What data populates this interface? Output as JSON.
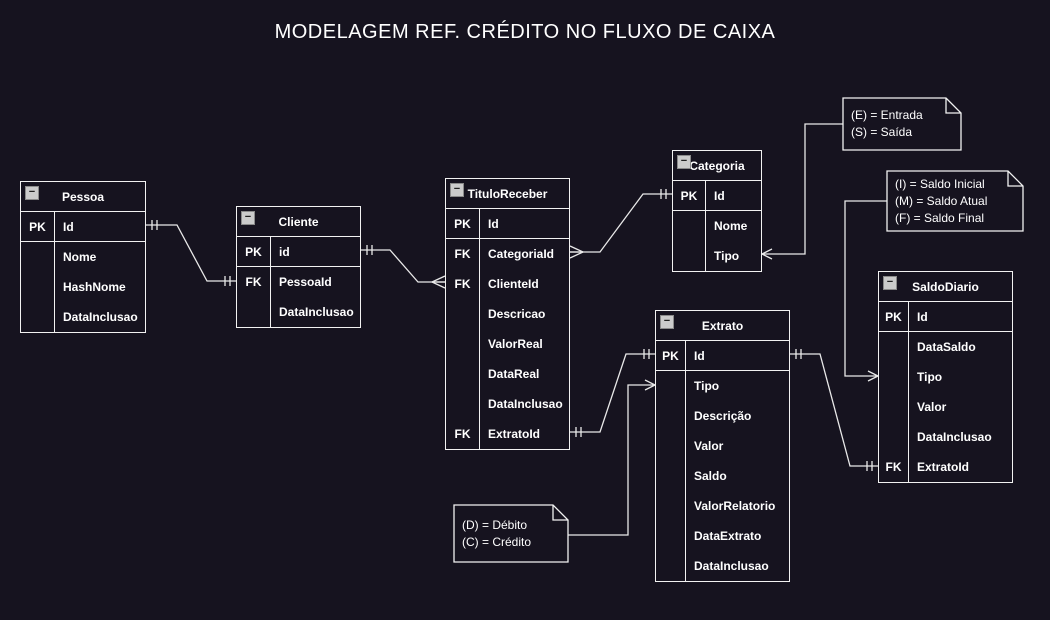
{
  "title": "MODELAGEM REF. CRÉDITO NO FLUXO DE CAIXA",
  "colors": {
    "background": "#16131f",
    "stroke": "#e9e9e9",
    "entity_border": "#f2f2f2",
    "text": "#ffffff",
    "collapse_icon_bg": "#cbcbcb"
  },
  "collapse_glyph": "−",
  "entities": [
    {
      "id": "pessoa",
      "title": "Pessoa",
      "x": 20,
      "y": 181,
      "width": 126,
      "keyColWidth": 34,
      "rows": [
        {
          "key": "PK",
          "name": "Id",
          "primary": true
        },
        {
          "key": "",
          "name": "Nome"
        },
        {
          "key": "",
          "name": "HashNome"
        },
        {
          "key": "",
          "name": "DataInclusao"
        }
      ]
    },
    {
      "id": "cliente",
      "title": "Cliente",
      "x": 236,
      "y": 206,
      "width": 125,
      "keyColWidth": 34,
      "rows": [
        {
          "key": "PK",
          "name": "id",
          "primary": true
        },
        {
          "key": "FK",
          "name": "PessoaId"
        },
        {
          "key": "",
          "name": "DataInclusao"
        }
      ]
    },
    {
      "id": "tituloreceber",
      "title": "TituloReceber",
      "x": 445,
      "y": 178,
      "width": 125,
      "keyColWidth": 34,
      "rows": [
        {
          "key": "PK",
          "name": "Id",
          "primary": true
        },
        {
          "key": "FK",
          "name": "CategoriaId"
        },
        {
          "key": "FK",
          "name": "ClienteId"
        },
        {
          "key": "",
          "name": "Descricao"
        },
        {
          "key": "",
          "name": "ValorReal"
        },
        {
          "key": "",
          "name": "DataReal"
        },
        {
          "key": "",
          "name": "DataInclusao"
        },
        {
          "key": "FK",
          "name": "ExtratoId"
        }
      ]
    },
    {
      "id": "categoria",
      "title": "Categoria",
      "x": 672,
      "y": 150,
      "width": 90,
      "keyColWidth": 33,
      "rows": [
        {
          "key": "PK",
          "name": "Id",
          "primary": true
        },
        {
          "key": "",
          "name": "Nome"
        },
        {
          "key": "",
          "name": "Tipo"
        }
      ]
    },
    {
      "id": "extrato",
      "title": "Extrato",
      "x": 655,
      "y": 310,
      "width": 135,
      "keyColWidth": 30,
      "rows": [
        {
          "key": "PK",
          "name": "Id",
          "primary": true
        },
        {
          "key": "",
          "name": "Tipo"
        },
        {
          "key": "",
          "name": "Descrição"
        },
        {
          "key": "",
          "name": "Valor"
        },
        {
          "key": "",
          "name": "Saldo"
        },
        {
          "key": "",
          "name": "ValorRelatorio"
        },
        {
          "key": "",
          "name": "DataExtrato"
        },
        {
          "key": "",
          "name": "DataInclusao"
        }
      ]
    },
    {
      "id": "saldodiario",
      "title": "SaldoDiario",
      "x": 878,
      "y": 271,
      "width": 135,
      "keyColWidth": 30,
      "rows": [
        {
          "key": "PK",
          "name": "Id",
          "primary": true
        },
        {
          "key": "",
          "name": "DataSaldo"
        },
        {
          "key": "",
          "name": "Tipo"
        },
        {
          "key": "",
          "name": "Valor"
        },
        {
          "key": "",
          "name": "DataInclusao"
        },
        {
          "key": "FK",
          "name": "ExtratoId"
        }
      ]
    }
  ],
  "notes": [
    {
      "id": "entrada-saida",
      "x": 843,
      "y": 98,
      "width": 118,
      "height": 52,
      "lines": [
        "(E) = Entrada",
        "(S) = Saída"
      ]
    },
    {
      "id": "saldo-legend",
      "x": 887,
      "y": 171,
      "width": 136,
      "height": 60,
      "lines": [
        "(I) = Saldo Inicial",
        "(M) = Saldo Atual",
        "(F) = Saldo Final"
      ]
    },
    {
      "id": "debito-credito",
      "x": 454,
      "y": 505,
      "width": 114,
      "height": 57,
      "lines": [
        "(D) = Débito",
        "(C) = Crédito"
      ]
    }
  ],
  "edges": [
    {
      "id": "pessoa-cliente",
      "from": "Pessoa.Id",
      "to": "Cliente.PessoaId",
      "points": [
        [
          146,
          225
        ],
        [
          177,
          225
        ],
        [
          207,
          281
        ],
        [
          236,
          281
        ]
      ],
      "startMarker": "one",
      "endMarker": "one"
    },
    {
      "id": "cliente-tituloreceber",
      "from": "Cliente.id",
      "to": "TituloReceber.ClienteId",
      "points": [
        [
          361,
          250
        ],
        [
          390,
          250
        ],
        [
          418,
          282
        ],
        [
          445,
          282
        ]
      ],
      "startMarker": "one",
      "endMarker": "many"
    },
    {
      "id": "tituloreceber-categoria",
      "from": "TituloReceber.CategoriaId",
      "to": "Categoria.Id",
      "points": [
        [
          570,
          252
        ],
        [
          600,
          252
        ],
        [
          643,
          194
        ],
        [
          672,
          194
        ]
      ],
      "startMarker": "many",
      "endMarker": "one"
    },
    {
      "id": "tituloreceber-extrato",
      "from": "TituloReceber.ExtratoId",
      "to": "Extrato.Id",
      "points": [
        [
          570,
          432
        ],
        [
          600,
          432
        ],
        [
          626,
          354
        ],
        [
          655,
          354
        ]
      ],
      "startMarker": "one",
      "endMarker": "one"
    },
    {
      "id": "extrato-saldodiario",
      "from": "Extrato.Id",
      "to": "SaldoDiario.ExtratoId",
      "points": [
        [
          790,
          354
        ],
        [
          820,
          354
        ],
        [
          850,
          466
        ],
        [
          878,
          466
        ]
      ],
      "startMarker": "one",
      "endMarker": "one"
    },
    {
      "id": "note-entrada-categoria",
      "from": "note-entrada-saida",
      "to": "Categoria.Tipo",
      "points": [
        [
          843,
          124
        ],
        [
          805,
          124
        ],
        [
          805,
          254
        ],
        [
          762,
          254
        ]
      ],
      "startMarker": "none",
      "endMarker": "arrow"
    },
    {
      "id": "note-saldo-saldodiario",
      "from": "note-saldo-legend",
      "to": "SaldoDiario.Tipo",
      "points": [
        [
          887,
          201
        ],
        [
          845,
          201
        ],
        [
          845,
          376
        ],
        [
          878,
          376
        ]
      ],
      "startMarker": "none",
      "endMarker": "arrow"
    },
    {
      "id": "note-debito-extrato",
      "from": "note-debito-credito",
      "to": "Extrato.Tipo",
      "points": [
        [
          568,
          535
        ],
        [
          628,
          535
        ],
        [
          628,
          385
        ],
        [
          655,
          385
        ]
      ],
      "startMarker": "none",
      "endMarker": "arrow"
    }
  ]
}
